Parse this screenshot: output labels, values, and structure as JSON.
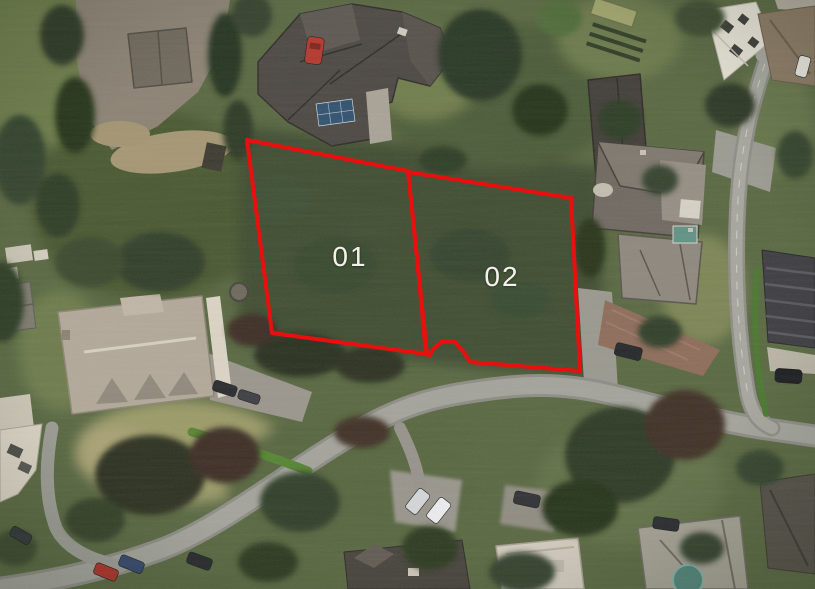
{
  "image": {
    "kind": "aerial-satellite-photo",
    "width": 815,
    "height": 589,
    "description": "Satellite view of a suburban neighbourhood with two wooded land plots outlined in red"
  },
  "overlay": {
    "accent_color": "#e8100e",
    "line_width": 4,
    "label_color": "#f2f1ea",
    "label_font_size": 28,
    "plots": [
      {
        "id": "plot-01",
        "label": "01",
        "label_x": 350,
        "label_y": 266,
        "points": [
          [
            247,
            140
          ],
          [
            408,
            171
          ],
          [
            417,
            258
          ],
          [
            426,
            354
          ],
          [
            272,
            333
          ]
        ]
      },
      {
        "id": "plot-02",
        "label": "02",
        "label_x": 502,
        "label_y": 286,
        "points": [
          [
            408,
            172
          ],
          [
            571,
            198
          ],
          [
            580,
            371
          ],
          [
            470,
            362
          ],
          [
            463,
            351
          ],
          [
            455,
            342
          ],
          [
            443,
            341
          ],
          [
            434,
            348
          ],
          [
            429,
            356
          ],
          [
            427,
            354
          ],
          [
            417,
            258
          ]
        ]
      }
    ]
  }
}
